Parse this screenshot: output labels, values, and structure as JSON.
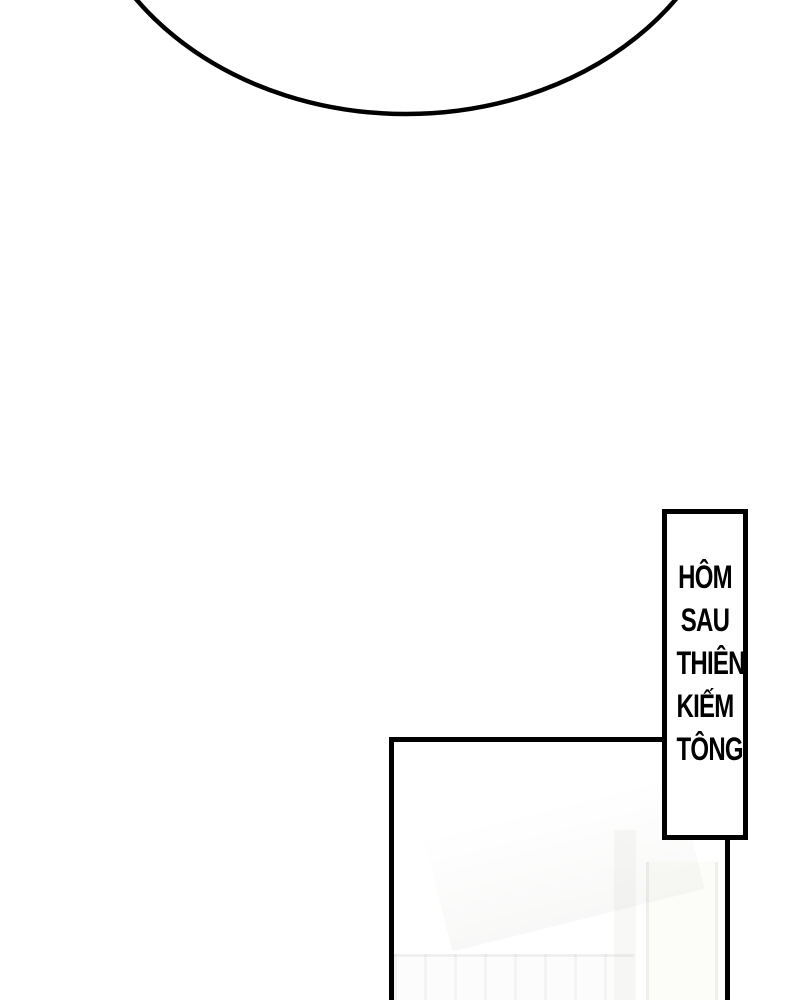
{
  "page": {
    "background_color": "#ffffff",
    "ink_color": "#000000",
    "kind": "comic-page"
  },
  "speech_bubble": {
    "type": "ellipse-arc-bottom",
    "stroke_color": "#000000",
    "fill_color": "#ffffff",
    "text": ""
  },
  "caption_box": {
    "full_text": "HÔM SAU THIÊN KIẾM TÔNG",
    "lines": [
      "HÔM",
      "SAU",
      "THIÊN",
      "KIẾM",
      "TÔNG"
    ],
    "border_color": "#000000",
    "background_color": "#ffffff",
    "text_color": "#000000"
  },
  "panel": {
    "border_color": "#000000",
    "fill_color": "#ffffff",
    "faint_art_color": "#f3f3f1"
  }
}
